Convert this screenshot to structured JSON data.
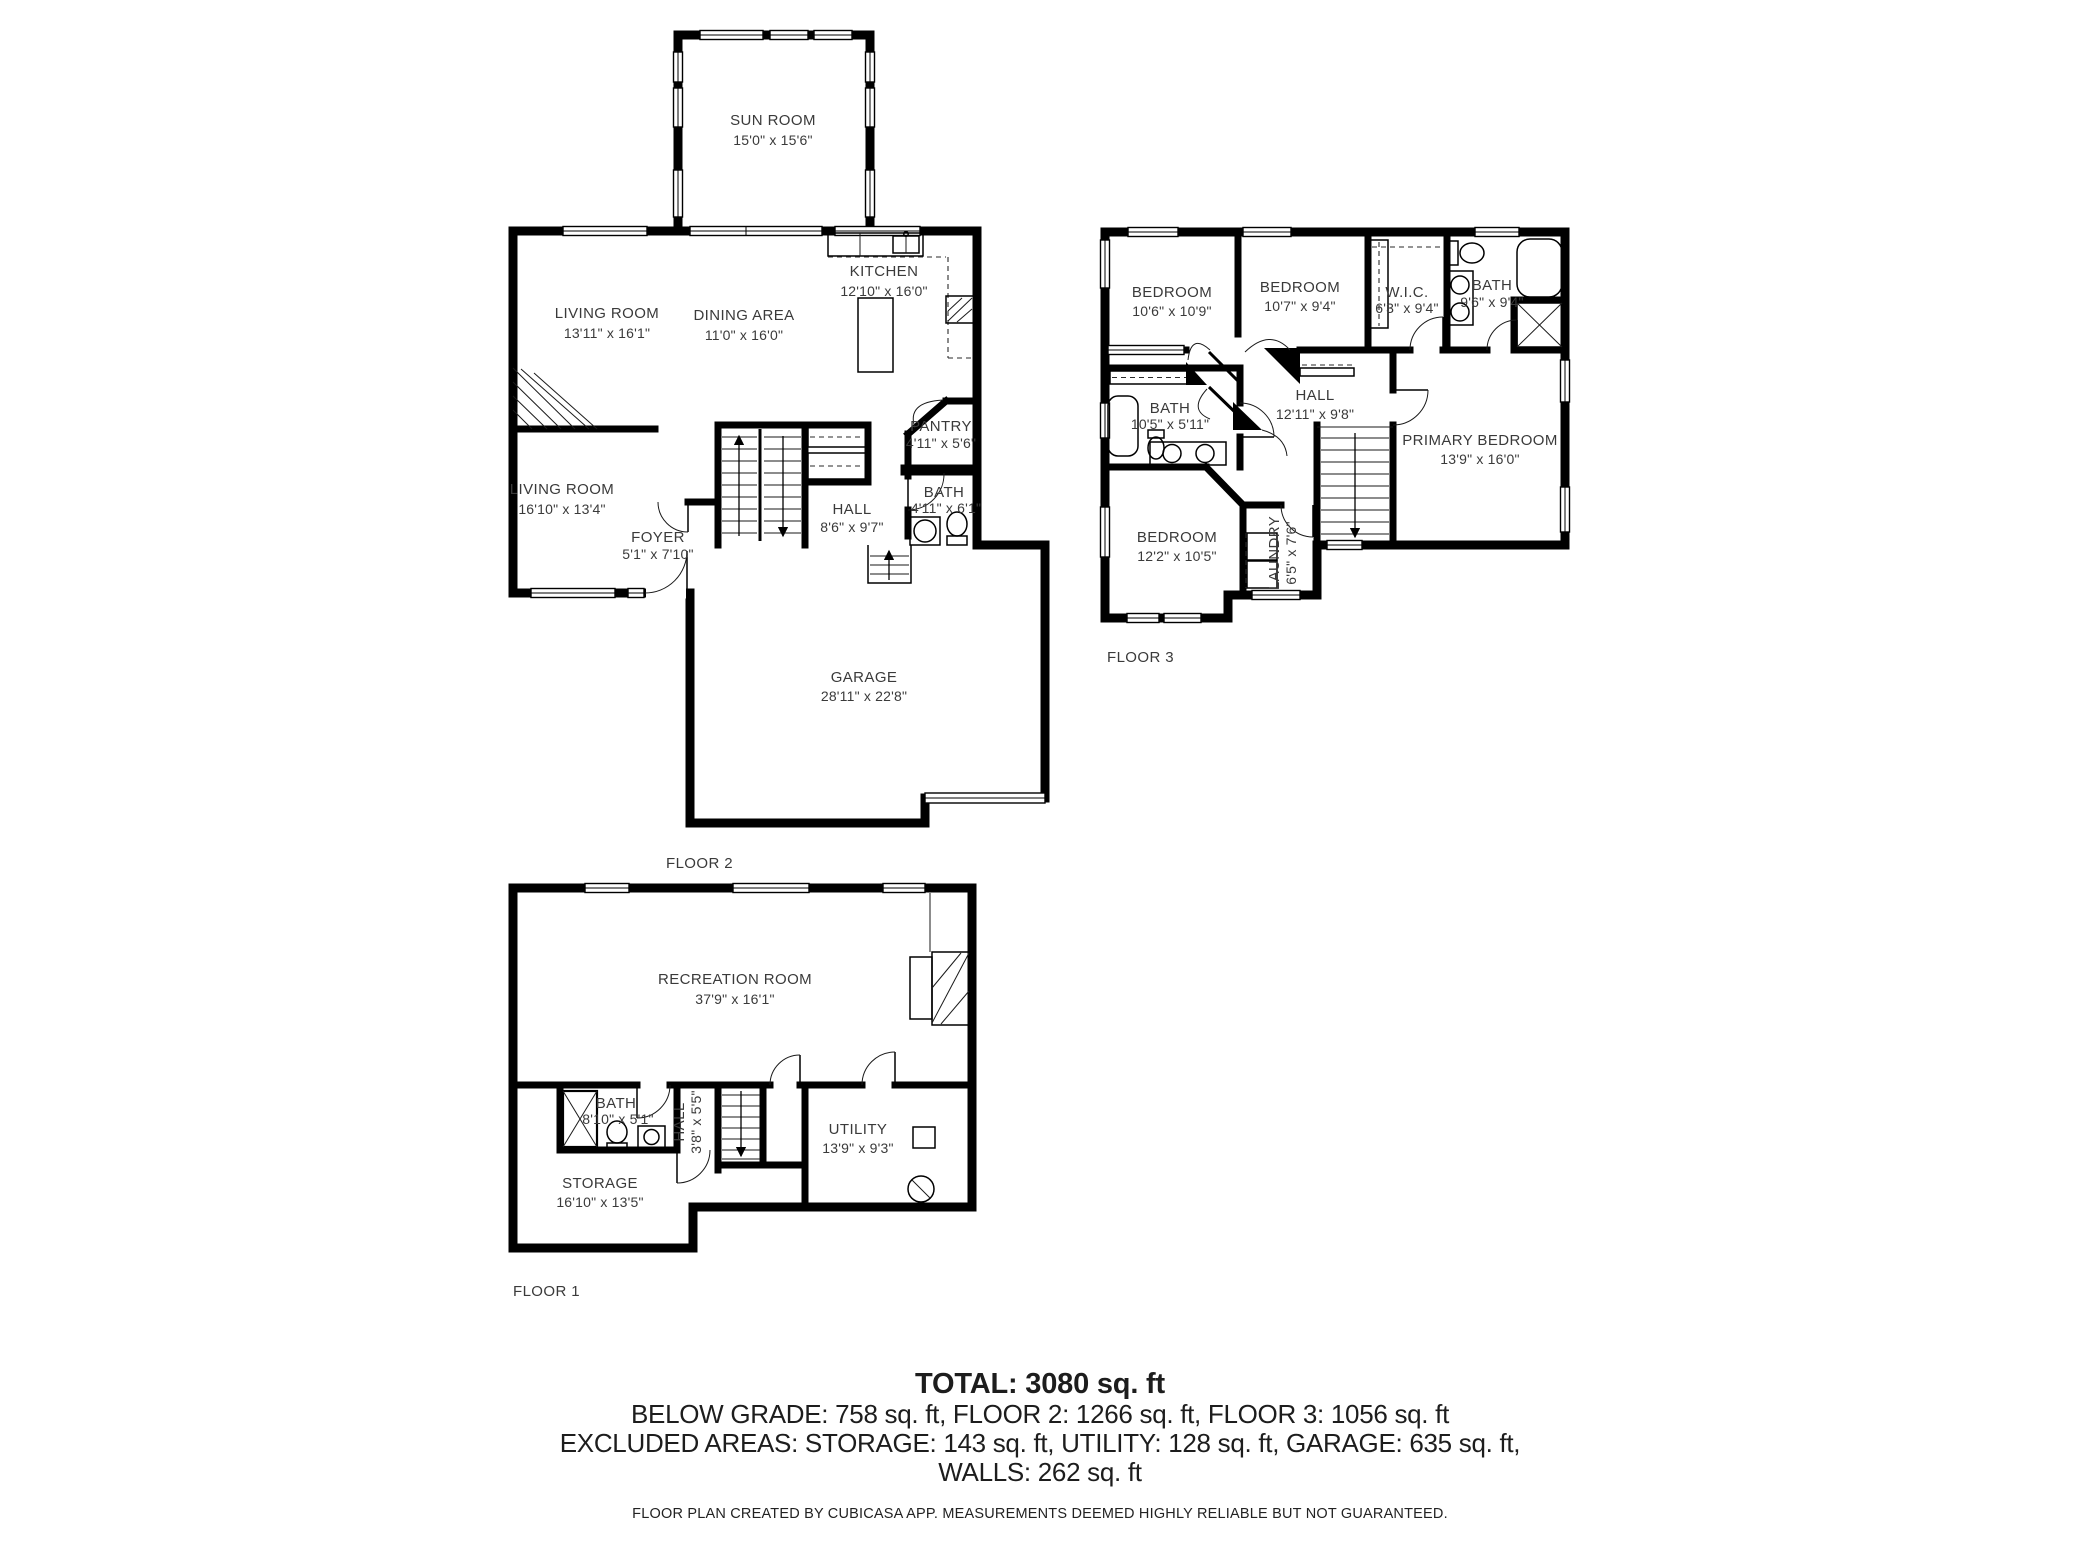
{
  "colors": {
    "walls": "#000000",
    "labels": "#3a3a3a",
    "background": "#ffffff"
  },
  "floors": {
    "floor2": {
      "label": "FLOOR 2",
      "rooms": {
        "sun_room": {
          "name": "SUN ROOM",
          "dims": "15'0\" x 15'6\""
        },
        "kitchen": {
          "name": "KITCHEN",
          "dims": "12'10\" x 16'0\""
        },
        "living_room_main": {
          "name": "LIVING ROOM",
          "dims": "13'11\" x 16'1\""
        },
        "dining_area": {
          "name": "DINING AREA",
          "dims": "11'0\" x 16'0\""
        },
        "pantry": {
          "name": "PANTRY",
          "dims": "4'11\" x 5'6\""
        },
        "living_room_lower": {
          "name": "LIVING ROOM",
          "dims": "16'10\" x 13'4\""
        },
        "foyer": {
          "name": "FOYER",
          "dims": "5'1\" x 7'10\""
        },
        "hall": {
          "name": "HALL",
          "dims": "8'6\" x 9'7\""
        },
        "bath": {
          "name": "BATH",
          "dims": "4'11\" x 6'1\""
        },
        "garage": {
          "name": "GARAGE",
          "dims": "28'11\" x 22'8\""
        }
      }
    },
    "floor3": {
      "label": "FLOOR 3",
      "rooms": {
        "bedroom_1": {
          "name": "BEDROOM",
          "dims": "10'6\" x 10'9\""
        },
        "bedroom_2": {
          "name": "BEDROOM",
          "dims": "10'7\" x 9'4\""
        },
        "wic": {
          "name": "W.I.C.",
          "dims": "6'3\" x 9'4\""
        },
        "bath_ensuite": {
          "name": "BATH",
          "dims": "9'6\" x 9'4\""
        },
        "bath_hall": {
          "name": "BATH",
          "dims": "10'5\" x 5'11\""
        },
        "hall": {
          "name": "HALL",
          "dims": "12'11\" x 9'8\""
        },
        "primary_bedroom": {
          "name": "PRIMARY BEDROOM",
          "dims": "13'9\" x 16'0\""
        },
        "bedroom_3": {
          "name": "BEDROOM",
          "dims": "12'2\" x 10'5\""
        },
        "laundry": {
          "name": "LAUNDRY",
          "dims": "6'5\" x 7'6\""
        }
      }
    },
    "floor1": {
      "label": "FLOOR 1",
      "rooms": {
        "recreation_room": {
          "name": "RECREATION ROOM",
          "dims": "37'9\" x 16'1\""
        },
        "bath": {
          "name": "BATH",
          "dims": "8'10\" x 5'1\""
        },
        "hall": {
          "name": "HALL",
          "dims": "3'8\" x 5'5\""
        },
        "utility": {
          "name": "UTILITY",
          "dims": "13'9\" x 9'3\""
        },
        "storage": {
          "name": "STORAGE",
          "dims": "16'10\" x 13'5\""
        }
      }
    }
  },
  "summary": {
    "total": "TOTAL: 3080 sq. ft",
    "line1": "BELOW GRADE: 758 sq. ft, FLOOR 2: 1266 sq. ft, FLOOR 3: 1056 sq. ft",
    "line2": "EXCLUDED AREAS: STORAGE: 143 sq. ft, UTILITY: 128 sq. ft, GARAGE: 635 sq. ft,",
    "line3": "WALLS: 262 sq. ft"
  },
  "footer": "FLOOR PLAN CREATED BY CUBICASA APP. MEASUREMENTS DEEMED HIGHLY RELIABLE BUT NOT GUARANTEED."
}
